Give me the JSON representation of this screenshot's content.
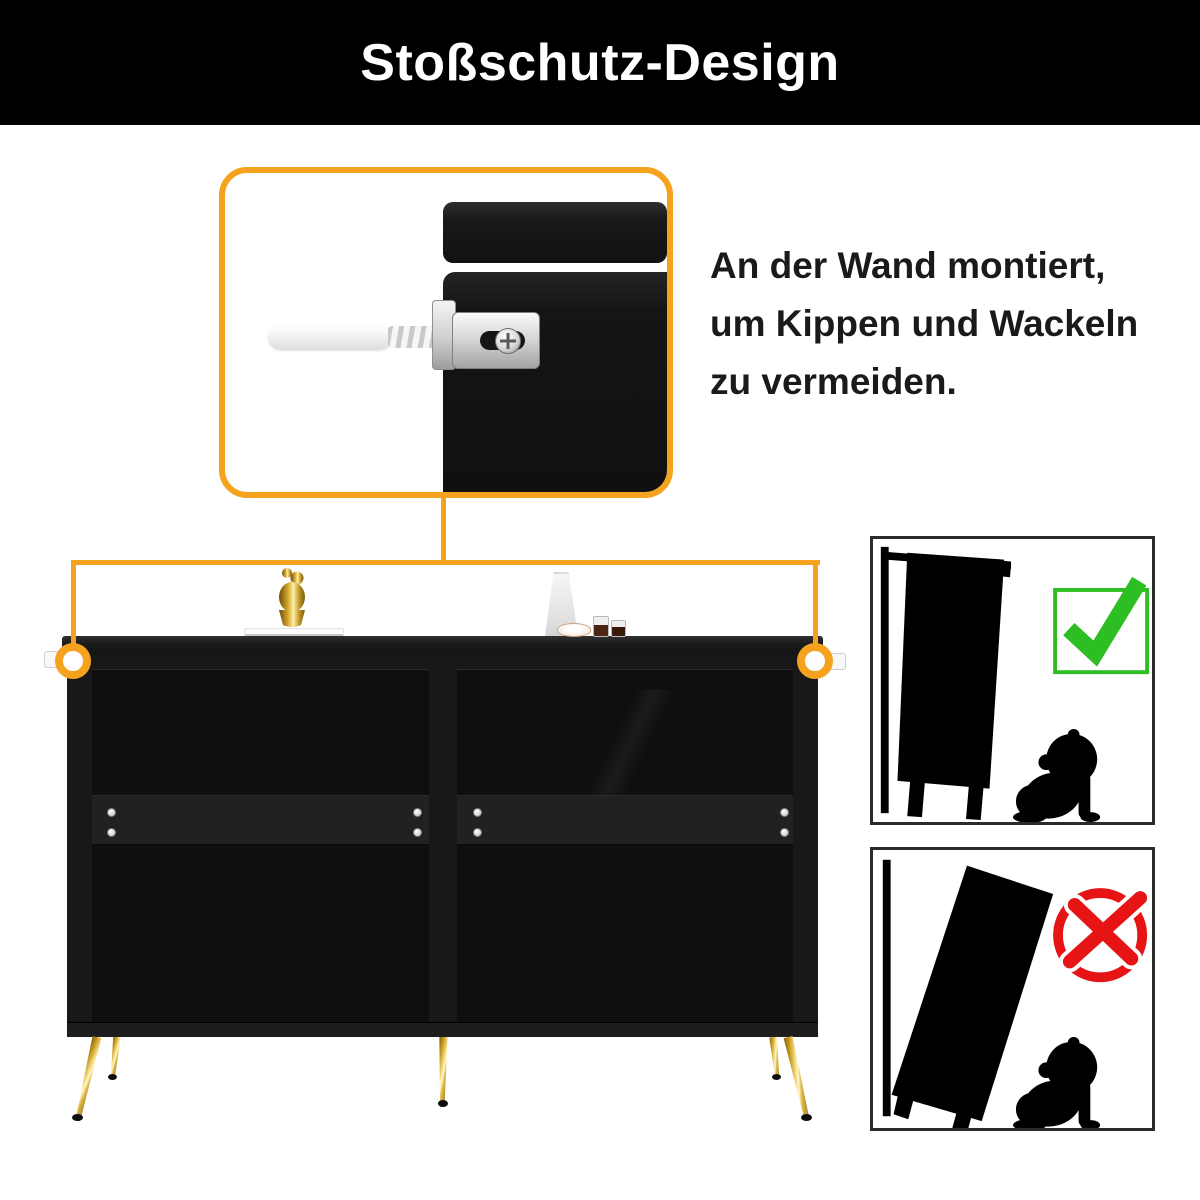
{
  "header": {
    "title": "Stoßschutz-Design"
  },
  "feature_text": {
    "line1": "An der Wand montiert,",
    "line2": "um Kippen und Wackeln",
    "line3": "zu vermeiden."
  },
  "colors": {
    "accent": "#F5A21E",
    "green": "#2CBE22",
    "red": "#E61414",
    "text": "#1A1A1A",
    "banner": "#000000"
  },
  "callout": {
    "subject": "wall-mount anti-tip bracket with wall anchor screw"
  },
  "diagrams": {
    "correct": {
      "icon": "check-icon"
    },
    "incorrect": {
      "icon": "cross-icon"
    }
  }
}
